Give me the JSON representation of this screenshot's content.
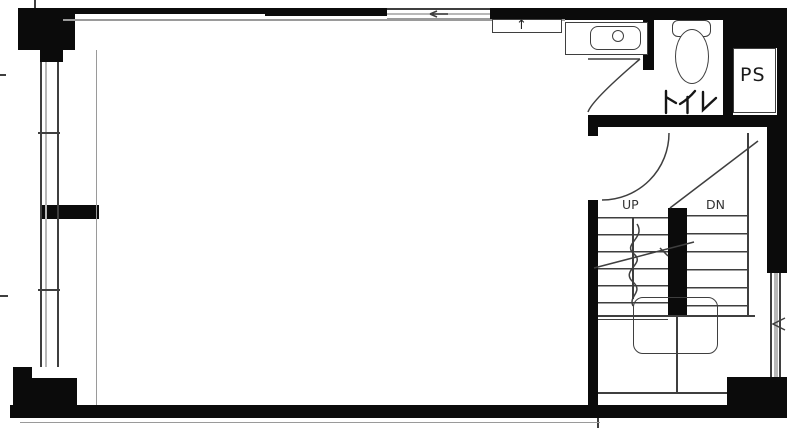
{
  "labels": {
    "toilet": "トイレ",
    "pipe_space": "PS",
    "stairs_up": "UP",
    "stairs_down": "DN"
  },
  "symbols": {
    "vent_arrow": "↑"
  },
  "colors": {
    "wall": "#0b0b0b",
    "line": "#3f3f3f",
    "line_light": "#9a9a9a",
    "window_fill": "#b8b8b8",
    "background": "#ffffff"
  }
}
